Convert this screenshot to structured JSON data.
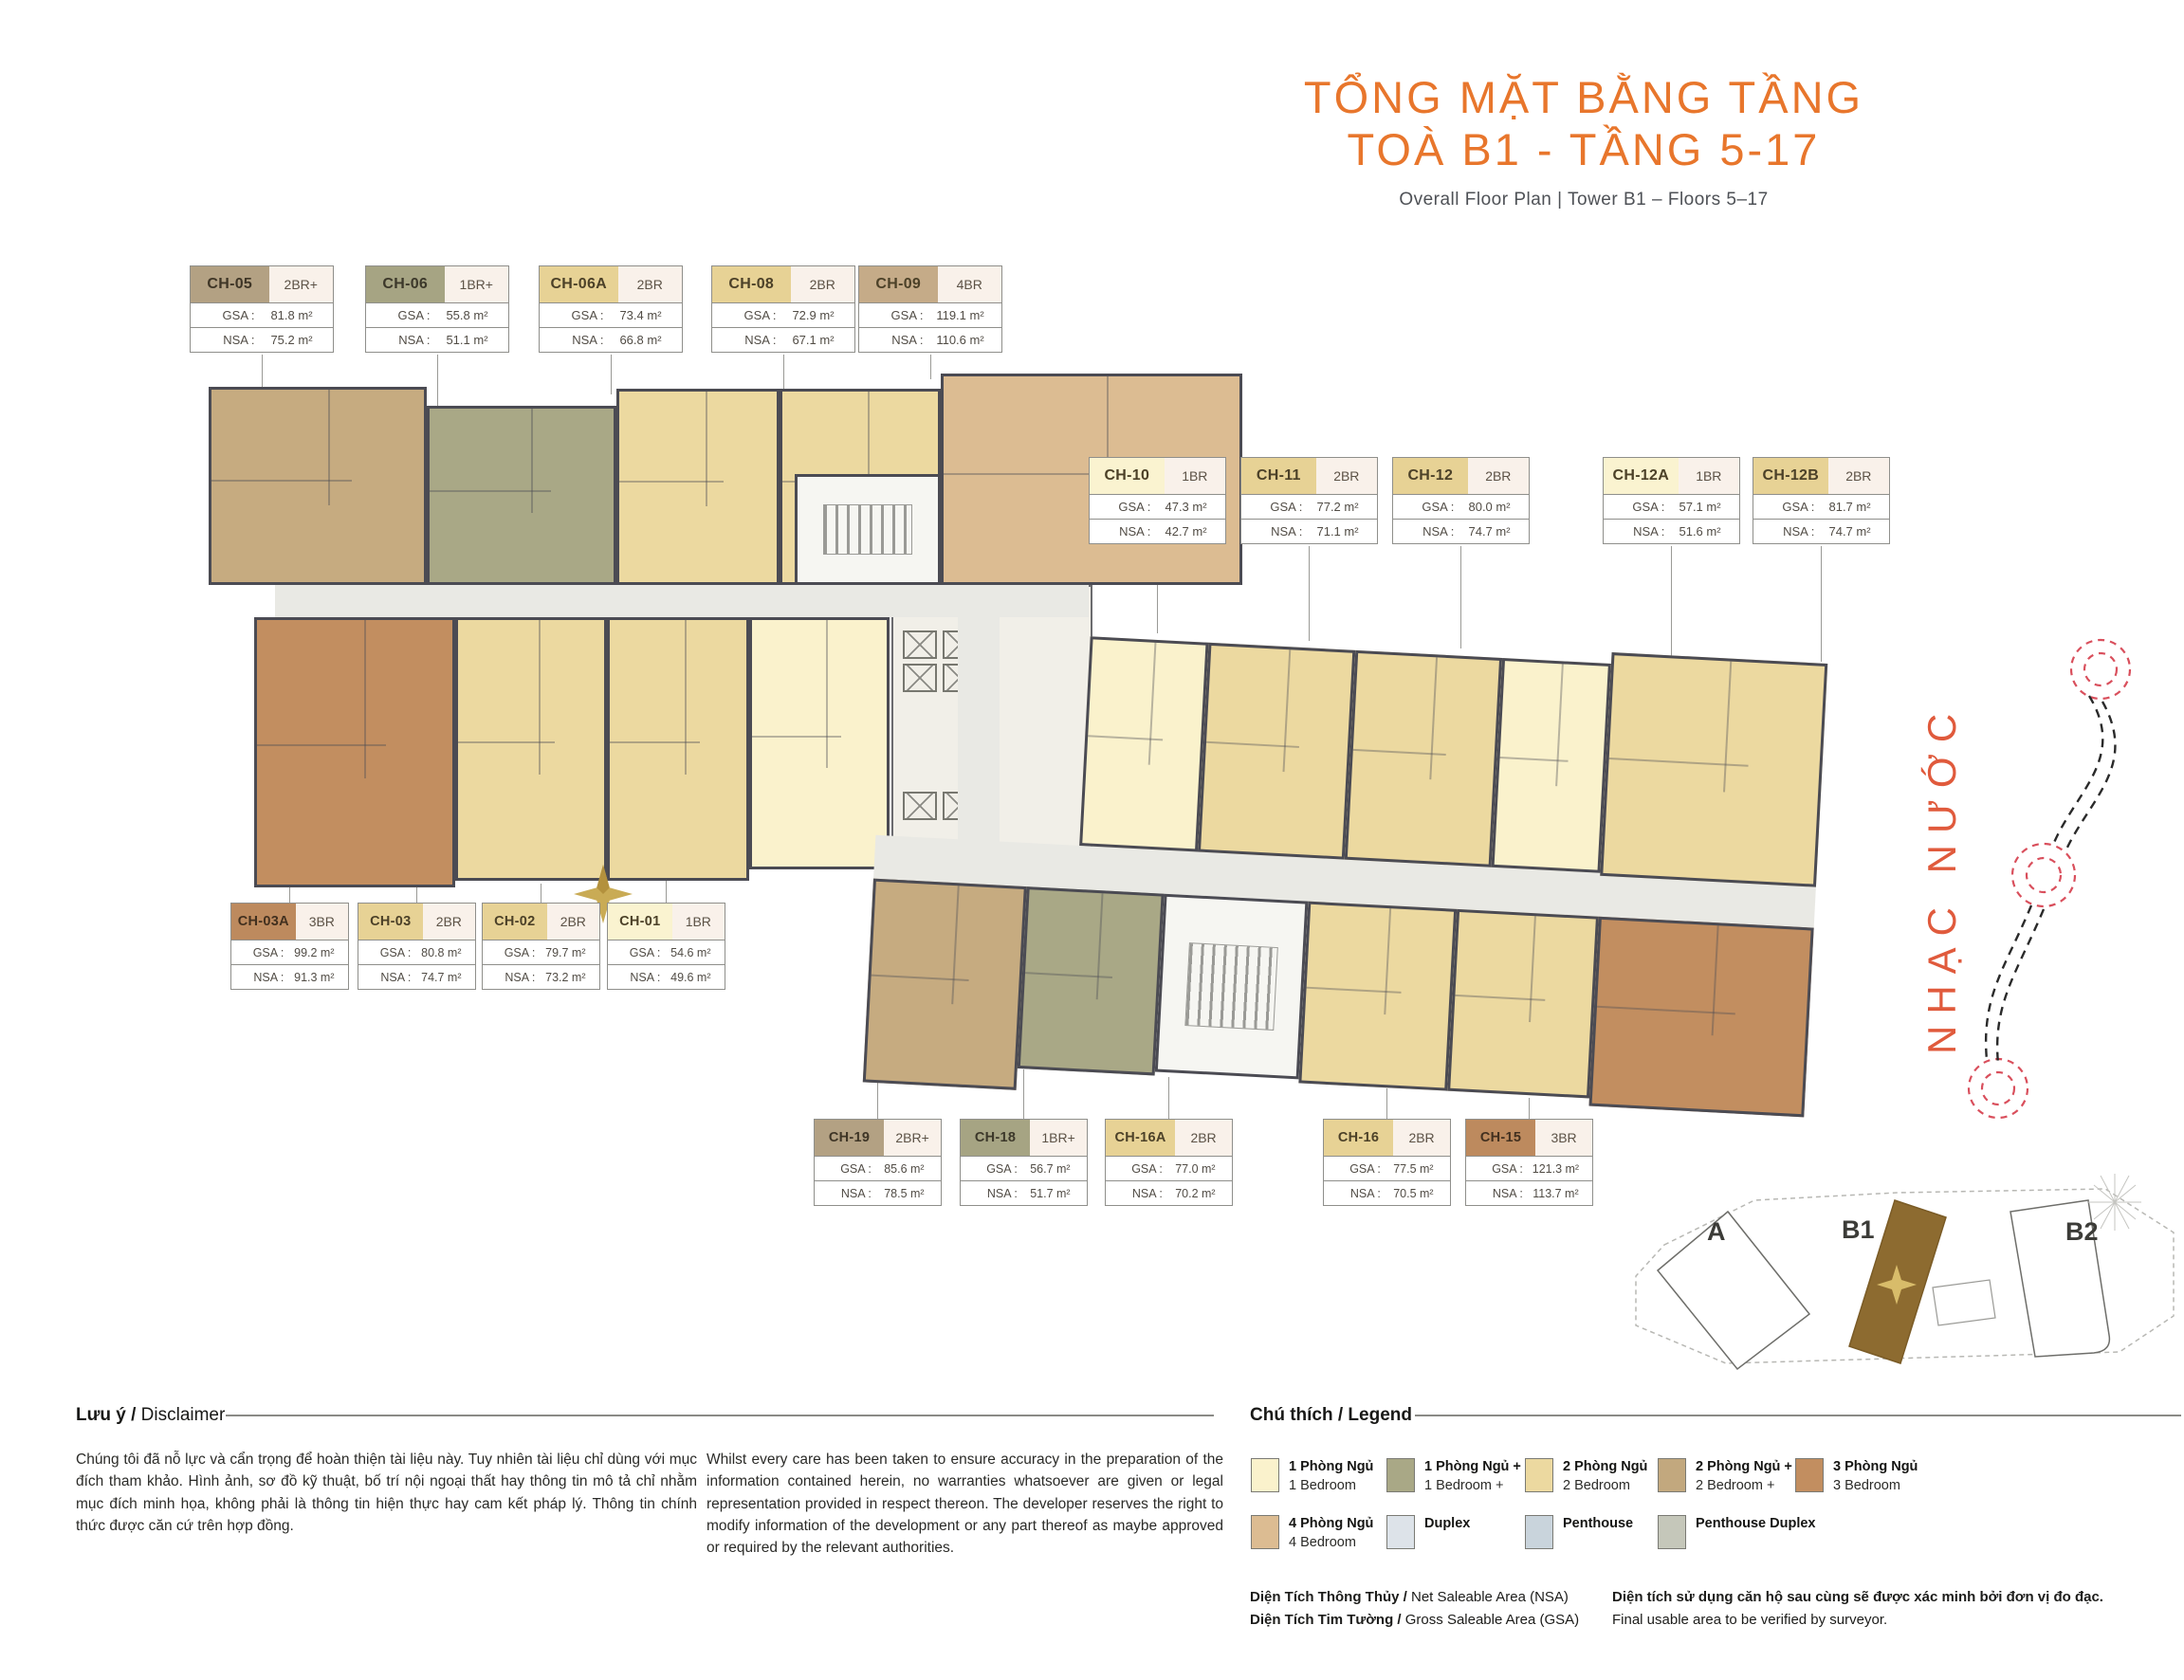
{
  "title": {
    "line1": "TỔNG MẶT BẰNG TẦNG",
    "line2": "TOÀ B1 - TẦNG 5-17",
    "subtitle": "Overall Floor Plan  |  Tower B1 – Floors 5–17"
  },
  "labels": {
    "gsa": "GSA :",
    "nsa": "NSA :"
  },
  "units": {
    "top": [
      {
        "code": "CH-05",
        "type": "2BR+",
        "gsa": "81.8 m²",
        "nsa": "75.2 m²"
      },
      {
        "code": "CH-06",
        "type": "1BR+",
        "gsa": "55.8 m²",
        "nsa": "51.1 m²"
      },
      {
        "code": "CH-06A",
        "type": "2BR",
        "gsa": "73.4 m²",
        "nsa": "66.8 m²"
      },
      {
        "code": "CH-08",
        "type": "2BR",
        "gsa": "72.9 m²",
        "nsa": "67.1 m²"
      },
      {
        "code": "CH-09",
        "type": "4BR",
        "gsa": "119.1 m²",
        "nsa": "110.6 m²"
      }
    ],
    "right": [
      {
        "code": "CH-10",
        "type": "1BR",
        "gsa": "47.3 m²",
        "nsa": "42.7 m²"
      },
      {
        "code": "CH-11",
        "type": "2BR",
        "gsa": "77.2 m²",
        "nsa": "71.1 m²"
      },
      {
        "code": "CH-12",
        "type": "2BR",
        "gsa": "80.0 m²",
        "nsa": "74.7 m²"
      },
      {
        "code": "CH-12A",
        "type": "1BR",
        "gsa": "57.1 m²",
        "nsa": "51.6 m²"
      },
      {
        "code": "CH-12B",
        "type": "2BR",
        "gsa": "81.7 m²",
        "nsa": "74.7 m²"
      }
    ],
    "left": [
      {
        "code": "CH-03A",
        "type": "3BR",
        "gsa": "99.2 m²",
        "nsa": "91.3 m²"
      },
      {
        "code": "CH-03",
        "type": "2BR",
        "gsa": "80.8 m²",
        "nsa": "74.7 m²"
      },
      {
        "code": "CH-02",
        "type": "2BR",
        "gsa": "79.7 m²",
        "nsa": "73.2 m²"
      },
      {
        "code": "CH-01",
        "type": "1BR",
        "gsa": "54.6 m²",
        "nsa": "49.6 m²"
      }
    ],
    "bottom": [
      {
        "code": "CH-19",
        "type": "2BR+",
        "gsa": "85.6 m²",
        "nsa": "78.5 m²"
      },
      {
        "code": "CH-18",
        "type": "1BR+",
        "gsa": "56.7 m²",
        "nsa": "51.7 m²"
      },
      {
        "code": "CH-16A",
        "type": "2BR",
        "gsa": "77.0 m²",
        "nsa": "70.2 m²"
      },
      {
        "code": "CH-16",
        "type": "2BR",
        "gsa": "77.5 m²",
        "nsa": "70.5 m²"
      },
      {
        "code": "CH-15",
        "type": "3BR",
        "gsa": "121.3 m²",
        "nsa": "113.7 m²"
      }
    ]
  },
  "water_feature_label": "NHẠC NƯỚC",
  "key_plan": {
    "tower_a": "A",
    "tower_b1": "B1",
    "tower_b2": "B2"
  },
  "disclaimer": {
    "heading_vi": "Lưu ý /",
    "heading_en": " Disclaimer",
    "vi": "Chúng tôi đã nỗ lực và cẩn trọng để hoàn thiện tài liệu này. Tuy nhiên tài liệu chỉ dùng với mục đích tham khảo. Hình ảnh, sơ đồ kỹ thuật, bố trí nội ngoại thất hay thông tin mô tả chỉ nhằm mục đích minh họa, không phải là thông tin hiện thực hay cam kết pháp lý. Thông tin chính thức được căn cứ trên hợp đồng.",
    "en": "Whilst every care has been taken to ensure accuracy in the preparation of the information contained herein, no warranties whatsoever are given or legal representation provided in respect thereon. The developer reserves the right to modify information of the development or any part thereof as maybe approved or required by the relevant authorities."
  },
  "legend": {
    "heading": "Chú thích / Legend",
    "items": [
      {
        "vi": "1 Phòng Ngủ",
        "en": "1 Bedroom",
        "color": "#faf2cc"
      },
      {
        "vi": "1 Phòng Ngủ +",
        "en": "1 Bedroom +",
        "color": "#a9a886"
      },
      {
        "vi": "2 Phòng Ngủ",
        "en": "2 Bedroom",
        "color": "#ecd9a0"
      },
      {
        "vi": "2 Phòng Ngủ +",
        "en": "2 Bedroom +",
        "color": "#c2a87e"
      },
      {
        "vi": "3 Phòng Ngủ",
        "en": "3 Bedroom",
        "color": "#c28e60"
      },
      {
        "vi": "4 Phòng Ngủ",
        "en": "4 Bedroom",
        "color": "#dcbc92"
      },
      {
        "vi": "Duplex",
        "en": "",
        "color": "#dde3e9"
      },
      {
        "vi": "Penthouse",
        "en": "",
        "color": "#c9d4dc"
      },
      {
        "vi": "Penthouse Duplex",
        "en": "",
        "color": "#c5c7ba"
      }
    ],
    "nsa_def_vi": "Diện Tích Thông Thủy / ",
    "nsa_def_en": "Net Saleable Area (NSA)",
    "gsa_def_vi": "Diện Tích Tim Tường / ",
    "gsa_def_en": "Gross Saleable Area (GSA)",
    "note_vi": "Diện tích sử dụng căn hộ sau cùng sẽ được xác minh bởi đơn vị đo đạc.",
    "note_en": "Final usable area to be verified by surveyor."
  },
  "colors": {
    "accent_orange": "#e8762c",
    "water_orange": "#e05a3c",
    "wall": "#4b4b53",
    "tower_b1_fill": "#8d6b30"
  }
}
